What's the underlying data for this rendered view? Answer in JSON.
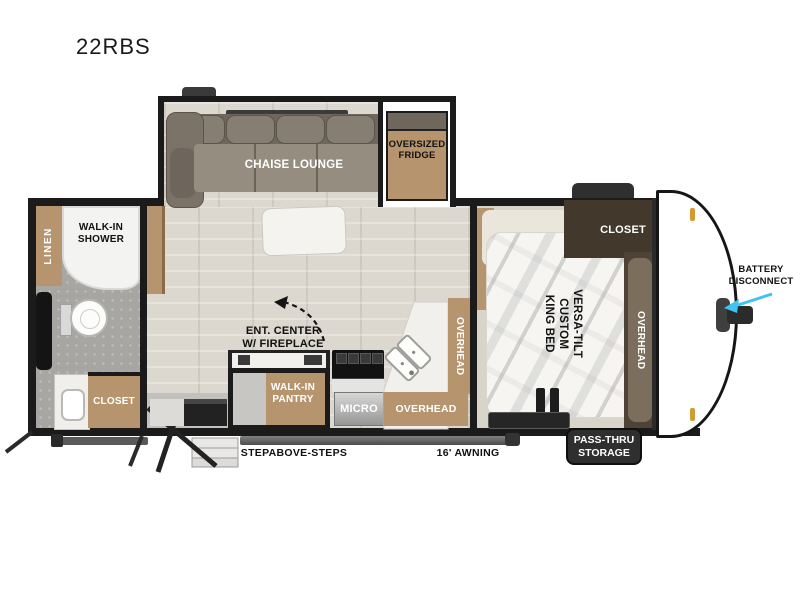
{
  "title": "22RBS",
  "labels": {
    "chaise_lounge": "CHAISE LOUNGE",
    "oversized_fridge": "OVERSIZED\nFRIDGE",
    "linen": "LINEN",
    "walk_in_shower": "WALK-IN\nSHOWER",
    "bath_closet": "CLOSET",
    "ent_center": "ENT. CENTER\nW/ FIREPLACE",
    "walk_in_pantry": "WALK-IN\nPANTRY",
    "micro": "MICRO",
    "overhead_kitchen": "OVERHEAD",
    "overhead_kitchen_side": "OVERHEAD",
    "king_bed": "VERSA-TILT\nCUSTOM\nKING BED",
    "bed_closet": "CLOSET",
    "overhead_bed": "OVERHEAD",
    "battery_disconnect": "BATTERY\nDISCONNECT",
    "pass_thru_storage": "PASS-THRU\nSTORAGE",
    "stepabove_steps": "STEPABOVE-STEPS",
    "awning": "16' AWNING"
  },
  "colors": {
    "wall": "#1b1b1b",
    "wood": "#b5946e",
    "dark_cabinet": "#42382c",
    "sofa": "#958d80",
    "arrow_accent": "#3ec4ee",
    "badge_bg": "#2f2f2f",
    "amber_light": "#d59a2f"
  }
}
